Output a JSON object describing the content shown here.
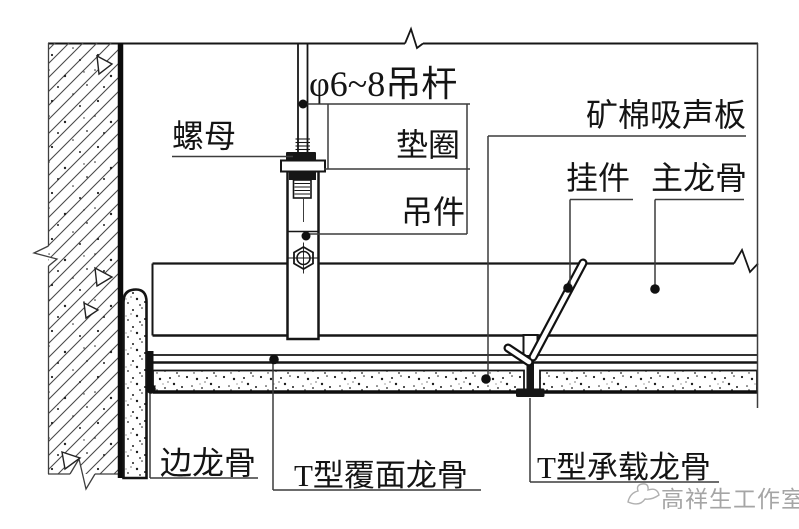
{
  "drawing": {
    "type": "suspended-ceiling-construction-detail",
    "labels": {
      "hanger_rod": "φ6~8吊杆",
      "nut": "螺母",
      "washer": "垫圈",
      "hanger": "吊件",
      "acoustic_panel": "矿棉吸声板",
      "clip": "挂件",
      "main_runner": "主龙骨",
      "edge_runner": "边龙骨",
      "t_facing_runner": "T型覆面龙骨",
      "t_bearing_runner": "T型承载龙骨"
    },
    "watermark": "高祥生工作室",
    "colors": {
      "line": "#161616",
      "leader": "#3c3c3c",
      "watermark": "#a5a5a5",
      "background": "#ffffff"
    }
  }
}
